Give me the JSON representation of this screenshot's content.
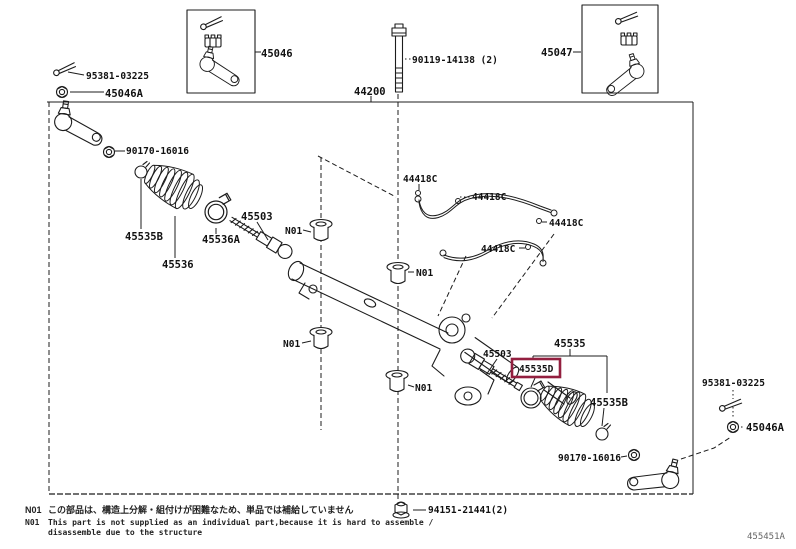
{
  "diagram": {
    "figure_code": "455451A",
    "highlight_color": "#931f3f",
    "labels": {
      "p45046": "45046",
      "p45047": "45047",
      "p44200": "44200",
      "p90119": "90119-14138 (2)",
      "p95381": "95381-03225",
      "p45046a": "45046A",
      "p90170": "90170-16016",
      "p45535b": "45535B",
      "p45536a": "45536A",
      "p45536": "45536",
      "p45503": "45503",
      "p44418c": "44418C",
      "p45535": "45535",
      "p45535d": "45535D",
      "p94151": "94151-21441(2)",
      "n01": "N01"
    },
    "notes": {
      "tag": "N01",
      "jp": "この部品は、構造上分解・組付けが困難なため、単品では補給していません",
      "en_line1": "This part is not supplied as an individual part,because it is hard to assemble /",
      "en_line2": "disassemble due to the structure"
    }
  }
}
